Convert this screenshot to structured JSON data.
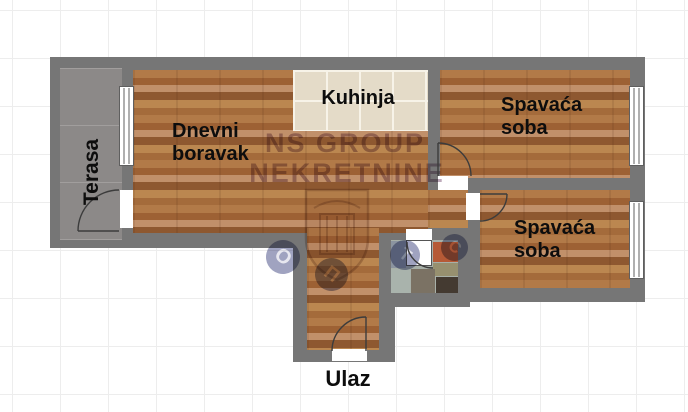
{
  "plan": {
    "rooms": [
      {
        "name": "terrace",
        "label": "Terasa"
      },
      {
        "name": "living-room",
        "label_line1": "Dnevni",
        "label_line2": "boravak"
      },
      {
        "name": "kitchen",
        "label": "Kuhinja"
      },
      {
        "name": "bedroom-1",
        "label_line1": "Spavaća",
        "label_line2": "soba"
      },
      {
        "name": "bedroom-2",
        "label_line1": "Spavaća",
        "label_line2": "soba"
      },
      {
        "name": "entrance",
        "label": "Ulaz"
      }
    ],
    "watermark": {
      "line1": "NS GROUP",
      "line2": "NEKRETNINE",
      "badge_letters": [
        "О",
        "П",
        "Т",
        "С"
      ]
    },
    "colors": {
      "wall": "#767676",
      "wood_floor": "#a9703f",
      "kitchen_tile": "#e4dbc8",
      "terrace_concrete": "#8c8988",
      "watermark_purple": "#7e5678",
      "watermark_navy": "#2d3273",
      "grid_line": "#ededed"
    }
  }
}
